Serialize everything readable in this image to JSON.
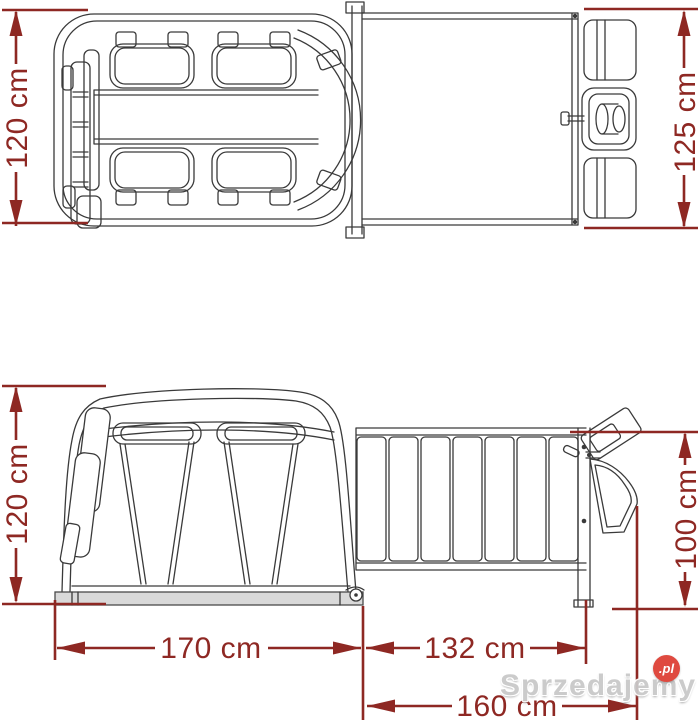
{
  "labels": {
    "top_view_height": "120 cm",
    "top_view_platform_height": "125 cm",
    "side_view_height": "120 cm",
    "side_view_rear_height": "100 cm",
    "width_body": "170 cm",
    "width_platform": "132 cm",
    "width_overall": "160 cm"
  },
  "watermark": {
    "text": "Sprzedajemy",
    "suffix": ".pl"
  },
  "colors": {
    "dimension_red": "#8e2823",
    "drawing_line": "#3a3a3a",
    "base_plate_gray": "#d9d9d9",
    "watermark_gray": "#c9c9c9",
    "watermark_badge_red": "#de4136",
    "background": "#ffffff"
  }
}
